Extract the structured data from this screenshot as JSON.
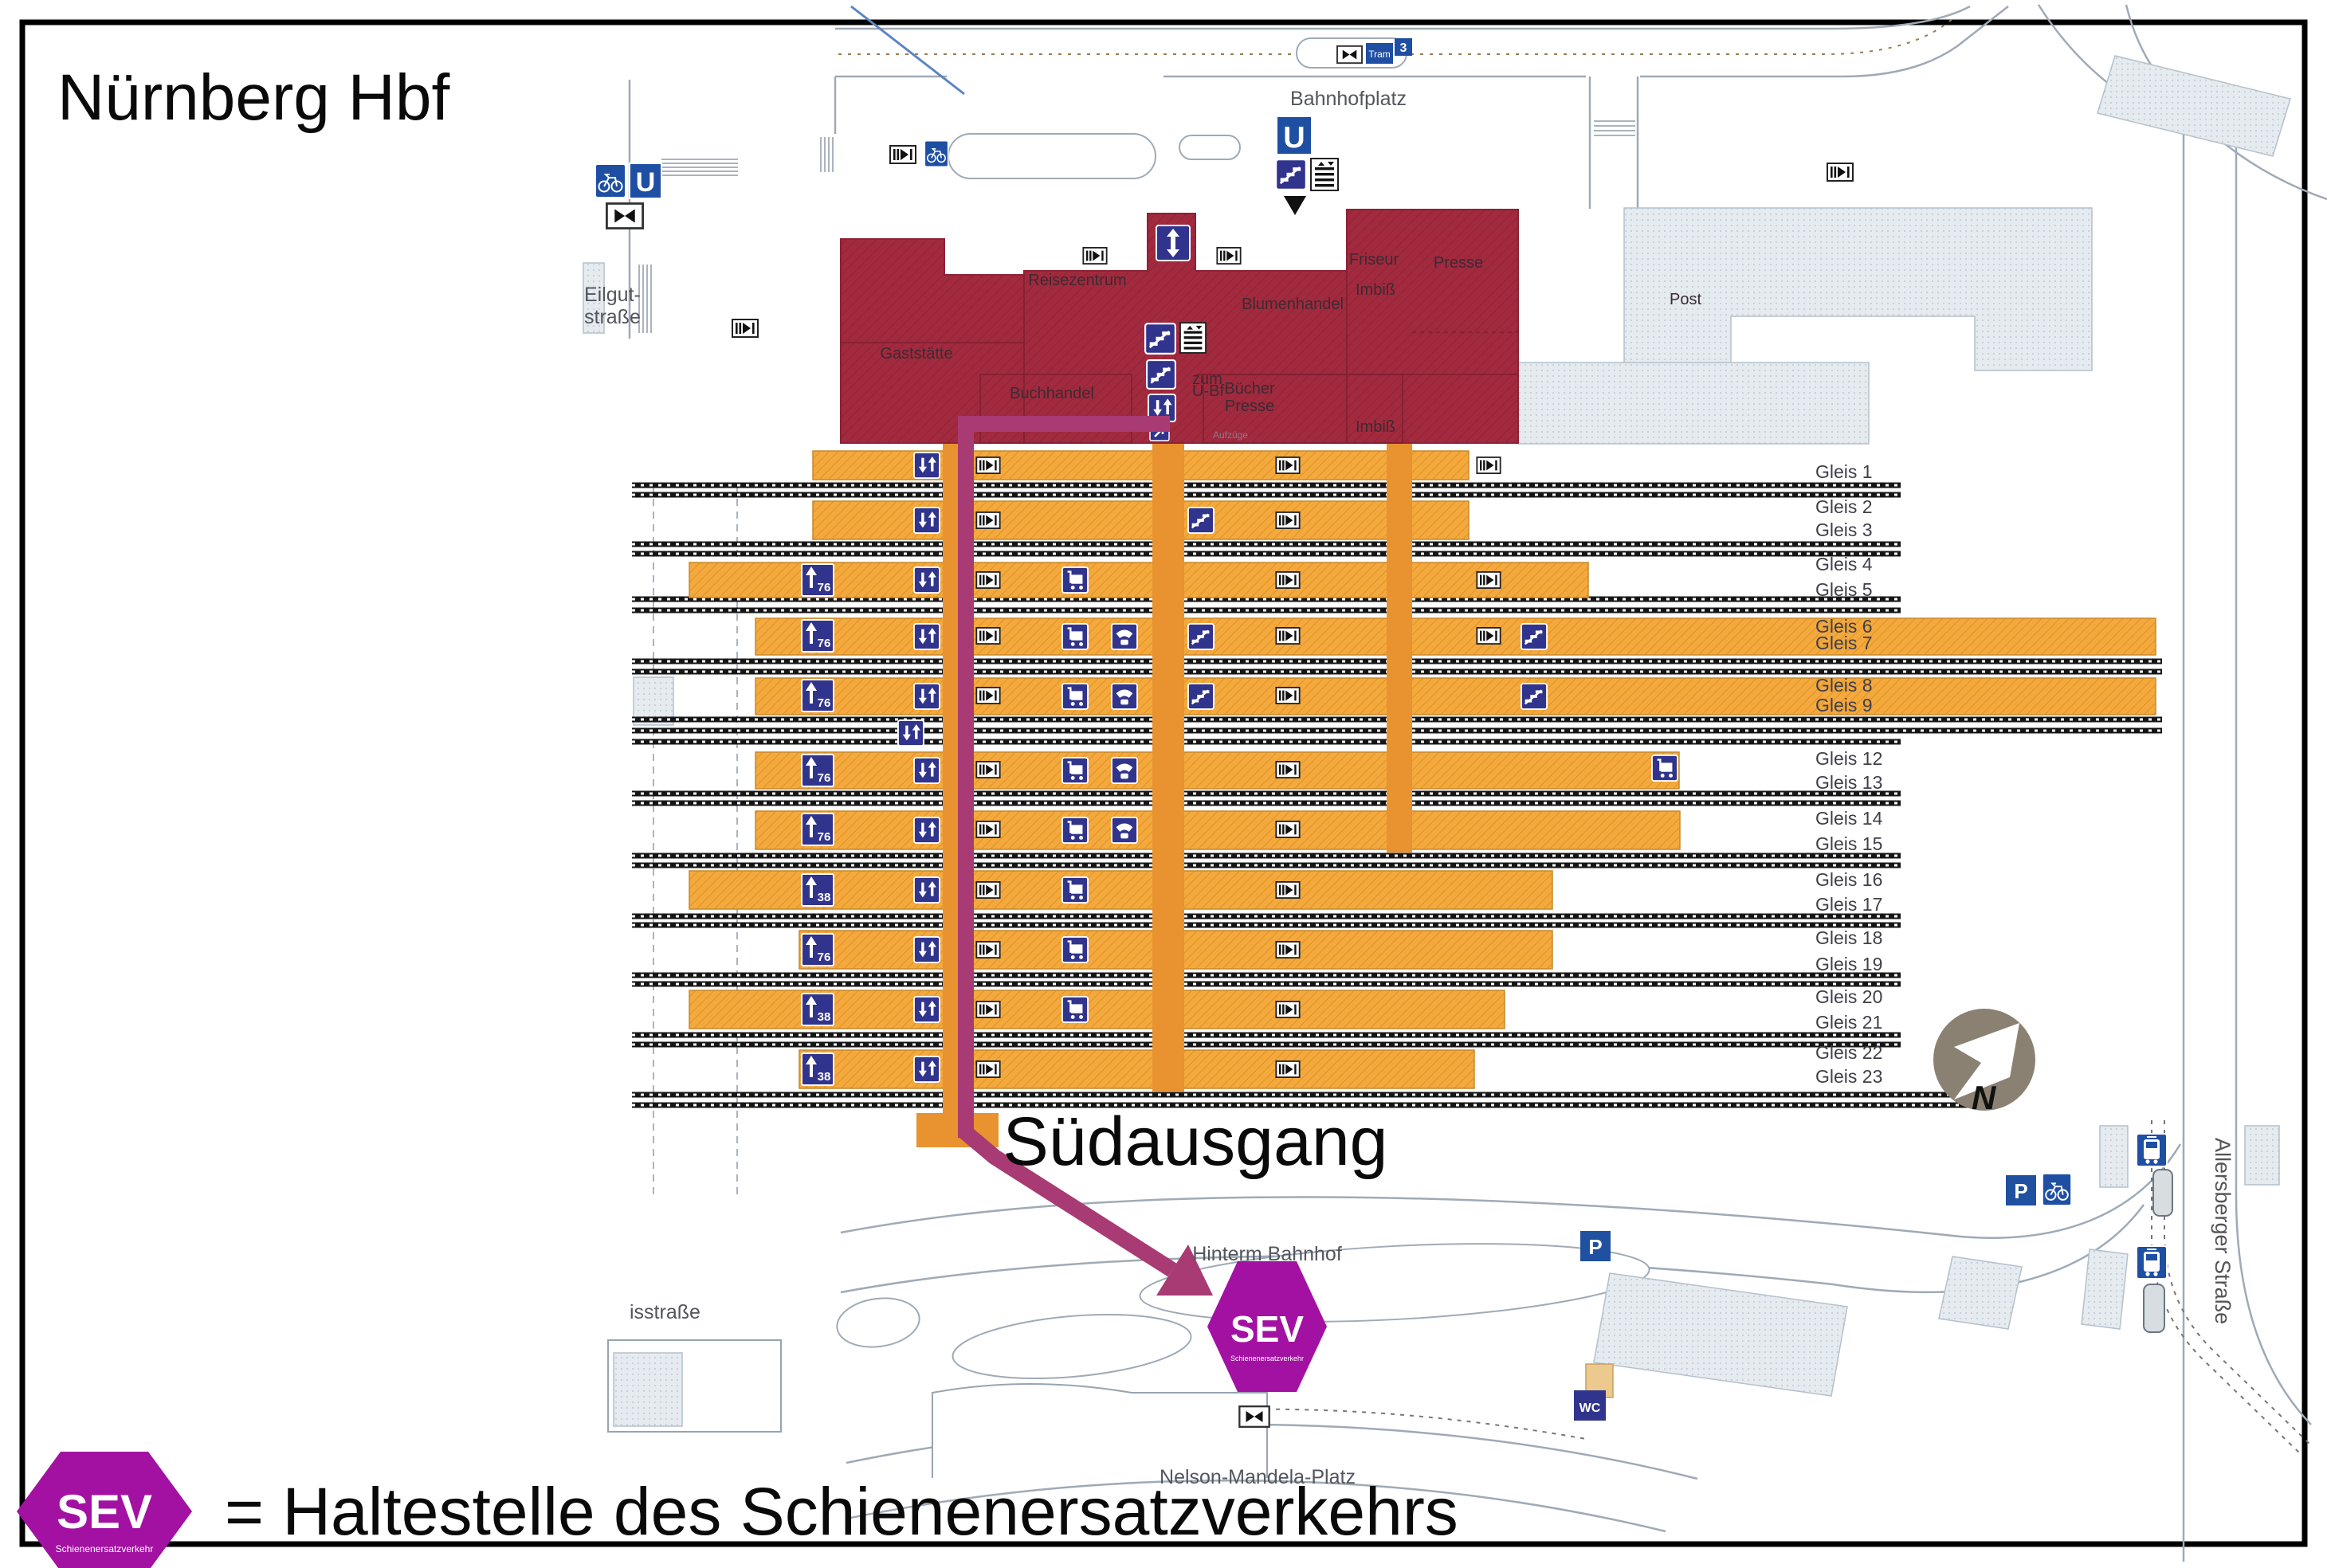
{
  "title": "Nürnberg Hbf",
  "legend": {
    "badge": "SEV",
    "badge_sub": "Schienenersatzverkehr",
    "text": "= Haltestelle des Schienenersatzverkehrs"
  },
  "map": {
    "suedausgang": "Südausgang",
    "sev_badge": {
      "label": "SEV",
      "sub": "Schienenersatzverkehr"
    },
    "streets": {
      "bahnhofplatz": "Bahnhofplatz",
      "eilgut1": "Eilgut-",
      "eilgut2": "straße",
      "isstrasse": "isstraße",
      "hinterm_bahnhof": "Hinterm Bahnhof",
      "nelson_mandela": "Nelson-Mandela-Platz",
      "allersberger": "Allersberger Straße"
    },
    "buildings": {
      "post": "Post",
      "gaststaette": "Gaststätte",
      "reisezentrum": "Reisezentrum",
      "buchhandel": "Buchhandel",
      "imbiss_a": "Imbiß",
      "blumenhandel": "Blumenhandel",
      "friseur": "Friseur",
      "imbiss_b": "Imbiß",
      "presse_a": "Presse",
      "buecher": "Bücher",
      "presse_b": "Presse",
      "imbiss_c": "Imbiß",
      "zum": "zum",
      "ubf": "U-Bf",
      "aufzuege": "Aufzüge"
    },
    "badges": {
      "u": "U",
      "p": "P",
      "wc": "WC",
      "tram": "Tram",
      "tram_line": "3",
      "north": "N"
    },
    "gleis": [
      "Gleis 1",
      "Gleis 2",
      "Gleis 3",
      "Gleis 4",
      "Gleis 5",
      "Gleis 6",
      "Gleis 7",
      "Gleis 8",
      "Gleis 9",
      "Gleis 12",
      "Gleis 13",
      "Gleis 14",
      "Gleis 15",
      "Gleis 16",
      "Gleis 17",
      "Gleis 18",
      "Gleis 19",
      "Gleis 20",
      "Gleis 21",
      "Gleis 22",
      "Gleis 23"
    ],
    "platform_signs": [
      "76",
      "76",
      "76",
      "76",
      "76",
      "38",
      "76",
      "38",
      "38"
    ]
  }
}
